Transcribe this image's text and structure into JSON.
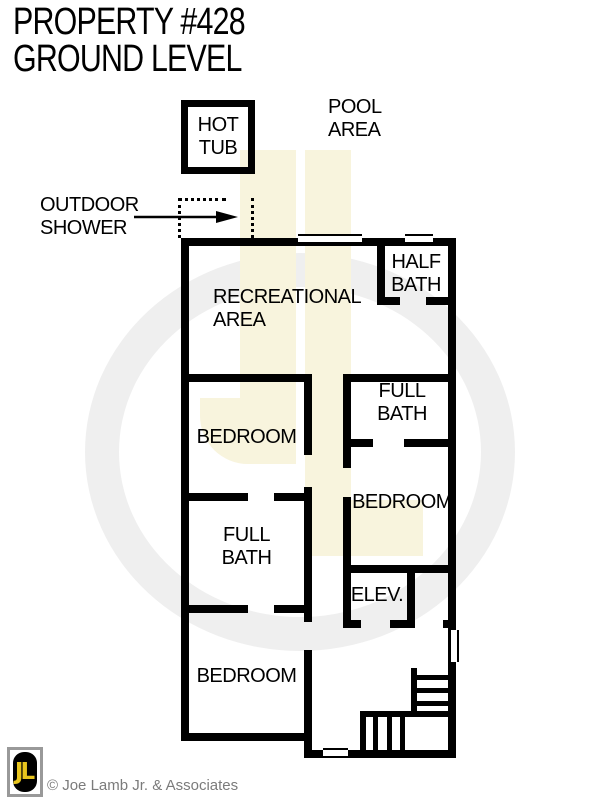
{
  "title": {
    "line1": "PROPERTY #428",
    "line2": "GROUND LEVEL"
  },
  "exterior": {
    "hot_tub": {
      "line1": "HOT",
      "line2": "TUB"
    },
    "pool_area": {
      "line1": "POOL",
      "line2": "AREA"
    },
    "outdoor_shower": {
      "line1": "OUTDOOR",
      "line2": "SHOWER"
    }
  },
  "rooms": {
    "recreational_area": {
      "line1": "RECREATIONAL",
      "line2": "AREA"
    },
    "half_bath": {
      "line1": "HALF",
      "line2": "BATH"
    },
    "bedroom_upper": {
      "label": "BEDROOM"
    },
    "full_bath_right": {
      "line1": "FULL",
      "line2": "BATH"
    },
    "bedroom_middle": {
      "label": "BEDROOM"
    },
    "full_bath_left": {
      "line1": "FULL",
      "line2": "BATH"
    },
    "elevator": {
      "label": "ELEV."
    },
    "bedroom_lower": {
      "label": "BEDROOM"
    }
  },
  "watermark": {
    "text": "JL"
  },
  "footer": {
    "logo_text": "JL",
    "copyright": "© Joe Lamb Jr. & Associates"
  },
  "colors": {
    "wall": "#000000",
    "logo_yellow": "#e8c51e",
    "watermark_yellow": "#f8f4dd",
    "watermark_gray": "#efefef",
    "copyright_gray": "#7b7b7b"
  }
}
